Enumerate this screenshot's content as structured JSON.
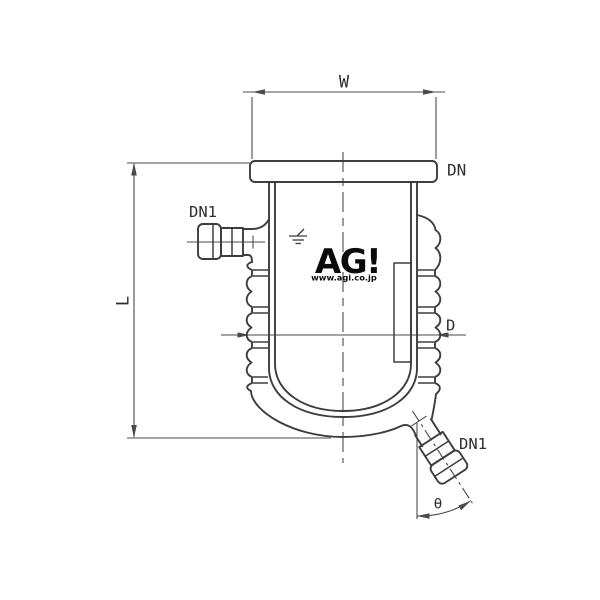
{
  "page": {
    "background": "#ffffff"
  },
  "drawing": {
    "stroke_color": "#3d3d3d",
    "dim_color": "#4a4a4a",
    "labels": {
      "width": "W",
      "flange": "DN",
      "side_port": "DN1",
      "length": "L",
      "diameter": "D",
      "bottom_port": "DN1",
      "angle": "θ"
    },
    "logo": {
      "text": "AG!",
      "site": "www.agi.co.jp"
    }
  }
}
